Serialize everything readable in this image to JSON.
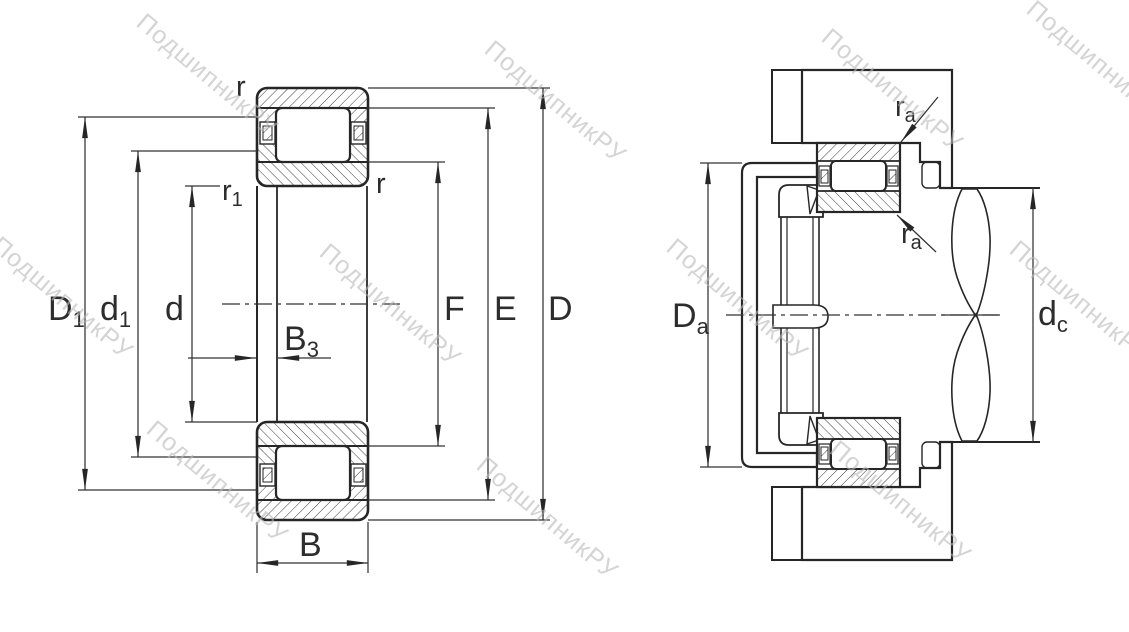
{
  "watermark": {
    "text": "ПодшипникРУ"
  },
  "colors": {
    "line": "#262626",
    "dim": "#333333",
    "watermark": "#b8b8b8",
    "background": "#ffffff"
  },
  "left_view": {
    "labels": {
      "D1": {
        "base": "D",
        "sub": "1"
      },
      "d1": {
        "base": "d",
        "sub": "1"
      },
      "d": "d",
      "B3": {
        "base": "B",
        "sub": "3"
      },
      "B": "B",
      "F": "F",
      "E": "E",
      "D": "D",
      "r_top": "r",
      "r_inner": "r",
      "r1": {
        "base": "r",
        "sub": "1"
      }
    }
  },
  "right_view": {
    "labels": {
      "Da": {
        "base": "D",
        "sub": "a"
      },
      "dc": {
        "base": "d",
        "sub": "c"
      },
      "ra_top": {
        "base": "r",
        "sub": "a"
      },
      "ra_bottom": {
        "base": "r",
        "sub": "a"
      }
    }
  }
}
